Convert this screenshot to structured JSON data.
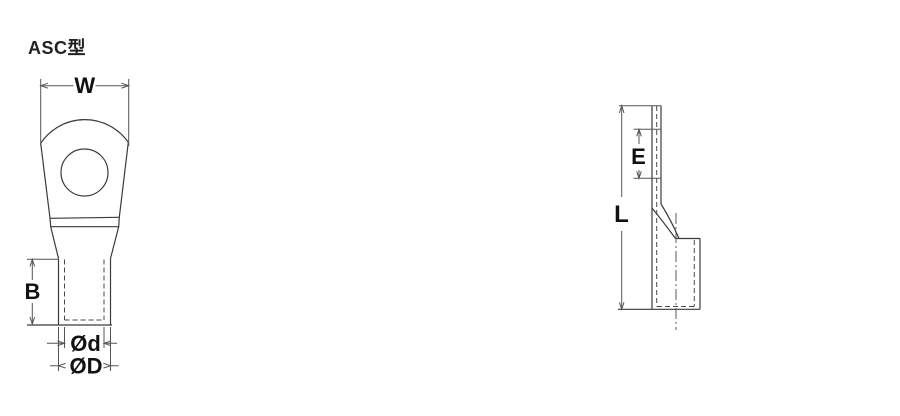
{
  "title": "ASC型",
  "colors": {
    "background": "#ffffff",
    "object_line": "#3a3a3a",
    "dimension_line": "#555555",
    "label_text": "#111111",
    "title_text": "#222222"
  },
  "front_view": {
    "description": "ring-tongue front view",
    "dimensions": {
      "width_label": "W",
      "barrel_height_label": "B",
      "inner_diameter_label": "Ød",
      "outer_diameter_label": "ØD"
    }
  },
  "side_view": {
    "description": "lug side profile view",
    "dimensions": {
      "tongue_offset_label": "E",
      "overall_length_label": "L"
    }
  }
}
